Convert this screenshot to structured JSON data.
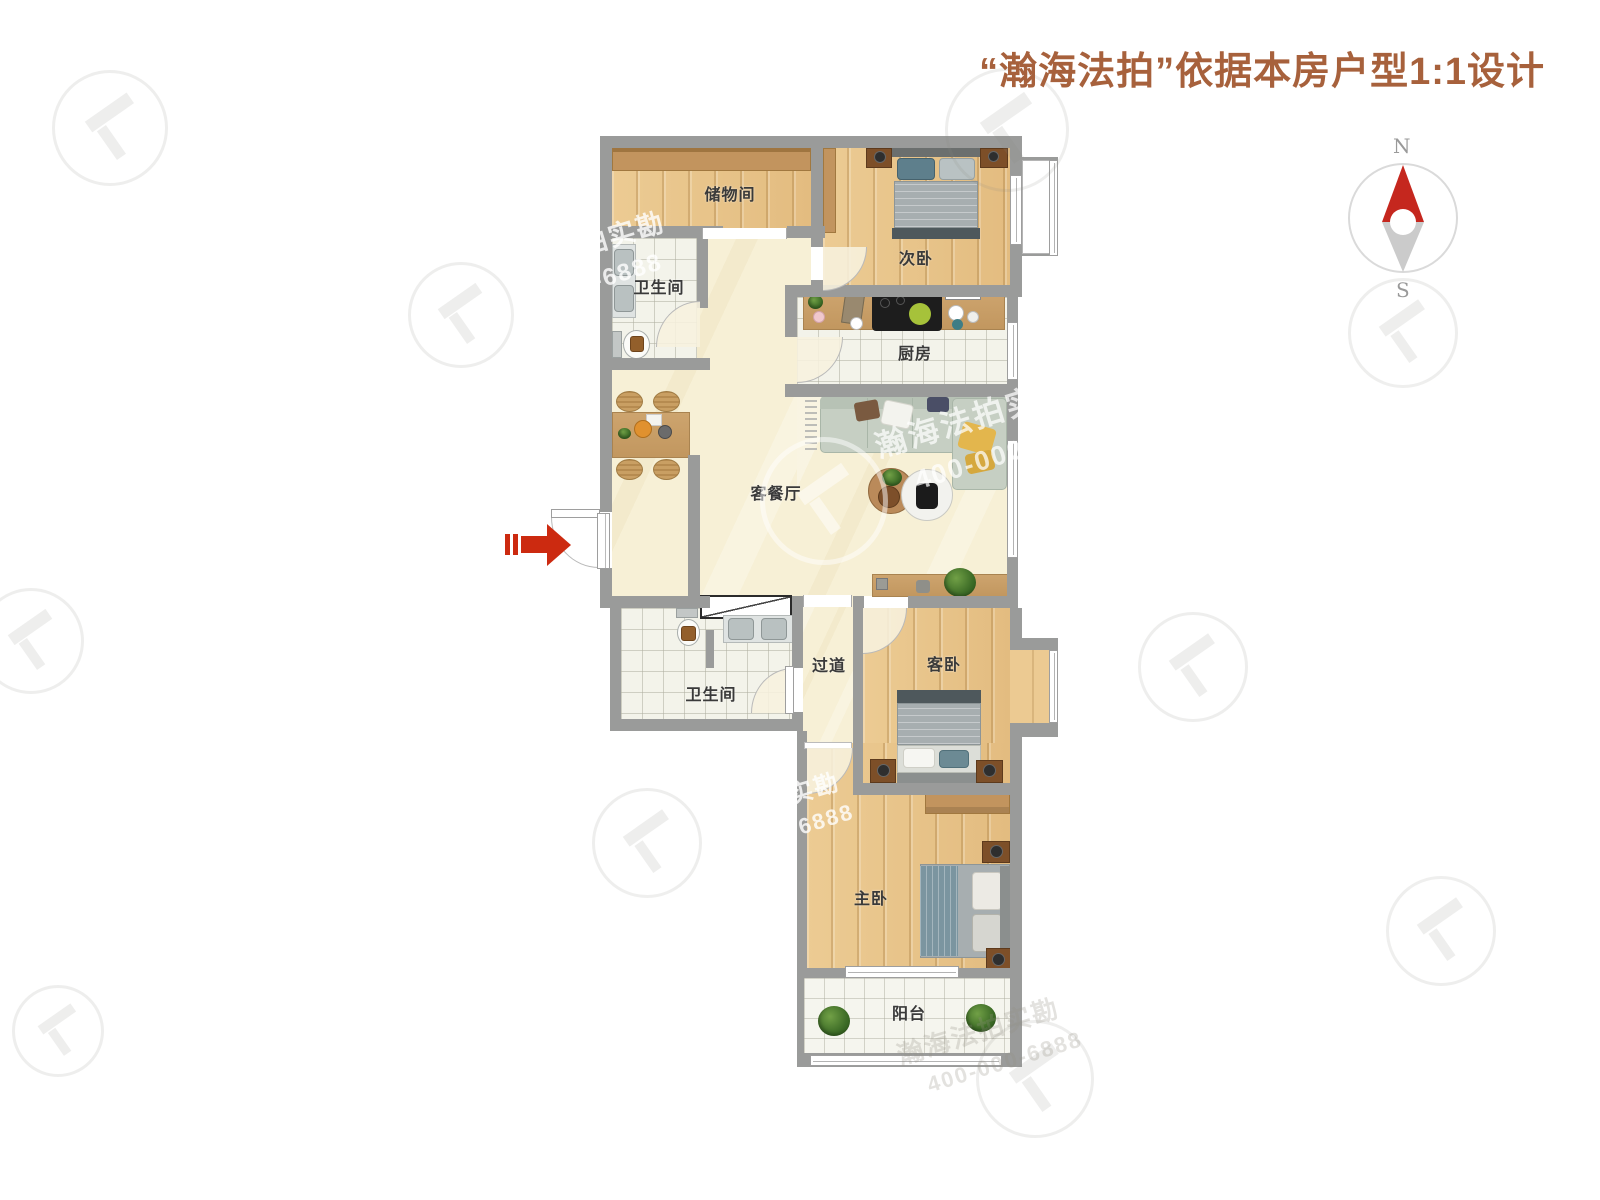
{
  "title": {
    "text": "“瀚海法拍”依据本房户型1:1设计"
  },
  "compass": {
    "north": "N",
    "south": "S"
  },
  "rooms": {
    "storage": {
      "label": "储物间"
    },
    "bath_top": {
      "label": "卫生间"
    },
    "bedroom_second": {
      "label": "次卧"
    },
    "kitchen": {
      "label": "厨房"
    },
    "living_dining": {
      "label": "客餐厅"
    },
    "hallway": {
      "label": "过道"
    },
    "bath_bottom": {
      "label": "卫生间"
    },
    "bedroom_guest": {
      "label": "客卧"
    },
    "bedroom_master": {
      "label": "主卧"
    },
    "balcony": {
      "label": "阳台"
    }
  },
  "watermarks": {
    "center_brand": "瀚海法拍实勘",
    "center_phone": "400-000-6888",
    "top_left_line1": "法拍实勘",
    "top_left_line2": "00-6888",
    "mid_line1": "实勘",
    "mid_line2": "6888",
    "bottom_brand": "瀚海法拍实勘",
    "bottom_phone": "400-000-6888"
  },
  "colors": {
    "title": "#a7613c",
    "wall": "#9a9b9a",
    "wood_floor": "#e9c68e",
    "cream_floor": "#f7f0d6",
    "tile_floor": "#f3f3ea",
    "entry_arrow_red": "#cc2a10",
    "compass_red": "#c5271e",
    "sofa_green": "#c6cfc3",
    "pillow_yellow": "#e3b64d"
  }
}
